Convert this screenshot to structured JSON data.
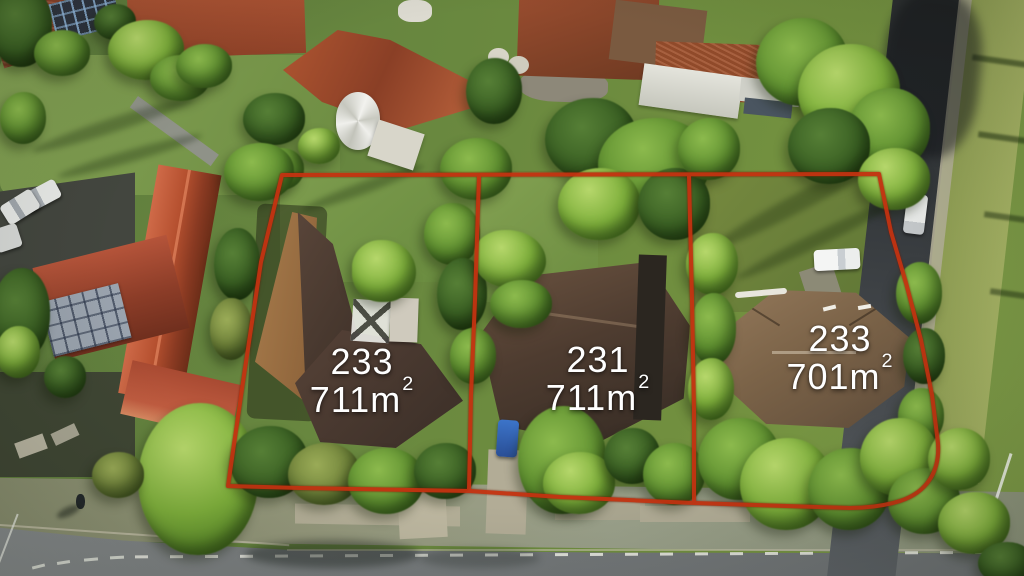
{
  "annotation": {
    "boundary_color": "#c43210",
    "label_color": "#ffffff"
  },
  "lots": [
    {
      "number": "233",
      "area_value": "711m",
      "area_sup": "2"
    },
    {
      "number": "231",
      "area_value": "711m",
      "area_sup": "2"
    },
    {
      "number": "233",
      "area_value": "701m",
      "area_sup": "2"
    }
  ]
}
